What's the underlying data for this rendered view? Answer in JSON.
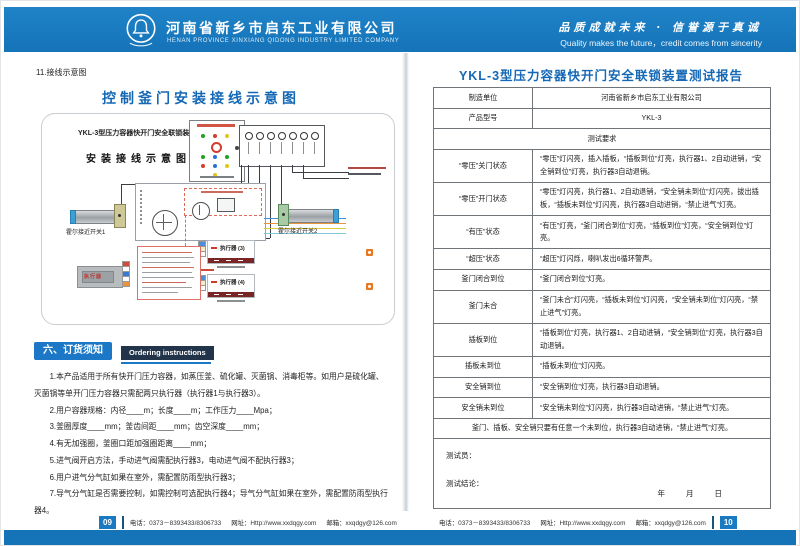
{
  "colors": {
    "header_blue": "#1779C2",
    "title_blue": "#1468B5",
    "heading_dark": "#22344A",
    "page_badge_blue": "#1A7AC1"
  },
  "header": {
    "company_cn": "河南省新乡市启东工业有限公司",
    "company_en": "HENAN PROVINCE XINXIANG QIDONG INDUSTRY LIMITED COMPANY",
    "slogan_cn": "品质成就未来 · 信誉源于真诚",
    "slogan_en": "Quality makes the future，credit comes from sincerity",
    "logo": "bell-emblem"
  },
  "left_page": {
    "section_label": "11.接线示意图",
    "title": "控制釜门安装接线示意图",
    "diagram": {
      "subtitle1": "YKL-3型压力容器快开门安全联锁装置",
      "subtitle2": "安装接线示意图",
      "hall_switch1": "霍尔接近开关1",
      "hall_switch2": "霍尔接近开关2",
      "executor3": "执行器 (3)",
      "executor4": "执行器 (4)",
      "executor_label": "执行器"
    },
    "ordering": {
      "heading_cn": "六、订货须知",
      "heading_en": "Ordering instructions",
      "items": [
        "1.本产品适用于所有快开门压力容器，如蒸压釜、硫化罐、灭菌锅、消毒柜等。如用户是硫化罐、灭菌锅等单开门压力容器只需配两只执行器（执行器1与执行器3）。",
        "2.用户容器规格：内径____m；长度____m；工作压力____Mpa；",
        "3.釜圈厚度____mm；釜齿间距____mm；齿空深度____mm；",
        "4.有无加强圈，釜圈口距加强圈距离____mm；",
        "5.进气阀开启方法，手动进气阀需配执行器3，电动进气阀不配执行器3；",
        "6.用户进气分气缸如果在室外，需配置防雨型执行器3；",
        "7.导气分气缸是否需要控制，如需控制可选配执行器4；导气分气缸如果在室外，需配置防雨型执行器4。"
      ]
    }
  },
  "right_page": {
    "title": "YKL-3型压力容器快开门安全联锁装置测试报告",
    "table": {
      "rows": [
        {
          "label": "制造单位",
          "content": "河南省新乡市启东工业有限公司",
          "center": true
        },
        {
          "label": "产品型号",
          "content": "YKL-3",
          "center": true
        },
        {
          "span": "测试要求"
        },
        {
          "label": "“零压”关门状态",
          "content": "“零压”灯闪亮，插入插板，“插板到位”灯亮，执行器1、2自动进销，“安全销到位”灯亮，执行器3自动退销。"
        },
        {
          "label": "“零压”开门状态",
          "content": "“零压”灯闪亮，执行器1、2自动退销，“安全销未到位”灯闪亮，拔出插板，“插板未到位”灯闪亮，执行器3自动进销，“禁止进气”灯亮。"
        },
        {
          "label": "“有压”状态",
          "content": "“有压”灯亮，“釜门闭合到位”灯亮，“插板到位”灯亮，“安全销到位”灯亮。"
        },
        {
          "label": "“超压”状态",
          "content": "“超压”灯闪烁，喇叭发出6循环警声。"
        },
        {
          "label": "釜门闭合到位",
          "content": "“釜门闭合到位”灯亮。"
        },
        {
          "label": "釜门未合",
          "content": "“釜门未合”灯闪亮，“插板未到位”灯闪亮，“安全销未到位”灯闪亮，“禁止进气”灯亮。"
        },
        {
          "label": "插板到位",
          "content": "“插板到位”灯亮，执行器1、2自动进销，“安全销到位”灯亮，执行器3自动退销。"
        },
        {
          "label": "插板未到位",
          "content": "“插板未到位”灯闪亮。"
        },
        {
          "label": "安全销到位",
          "content": "“安全销到位”灯亮，执行器3自动退销。"
        },
        {
          "label": "安全销未到位",
          "content": "“安全销未到位”灯闪亮，执行器3自动进销，“禁止进气”灯亮。"
        },
        {
          "span": "釜门、插板、安全销只要有任意一个未到位，执行器3自动进销，“禁止进气”灯亮。"
        }
      ],
      "tester_label": "测试员：",
      "conclusion_label": "测试结论：",
      "date_label": "年　　月　　日"
    }
  },
  "footer": {
    "page_left": "09",
    "page_right": "10",
    "phone_label": "电话：",
    "phone": "0373－8393433/8306733",
    "web_label": "网址：",
    "web": "Http://www.xxdqgy.com",
    "mail_label": "邮箱：",
    "mail": "xxqdgy@126.com"
  }
}
